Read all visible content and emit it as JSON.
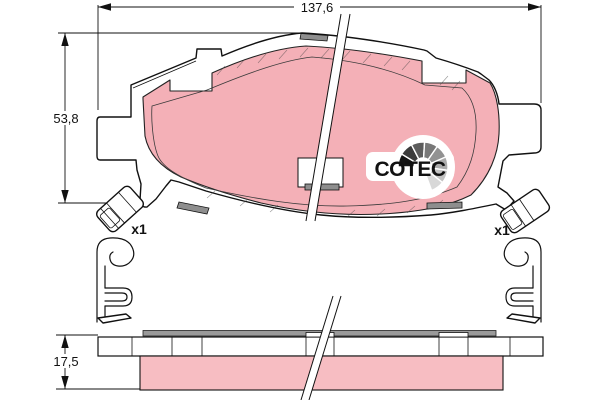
{
  "drawing": {
    "type_note": "brake-pad technical drawing, plan view with section and accessory clips",
    "brand_logo": {
      "text": "COTEC"
    },
    "dimensions": {
      "width_label": "137,6",
      "height_label": "53,8",
      "thickness_label": "17,5"
    },
    "accessories": {
      "left_clip_qty_label": "x1",
      "right_clip_qty_label": "x1"
    },
    "colors": {
      "friction_pink": "#f4b0b7",
      "section_pink": "#f7bdc2",
      "tab_gray": "#8e8e8e",
      "shim_gray": "#9a9a9a",
      "line_black": "#111111",
      "fan_colors": [
        "#141414",
        "#3c3c3c",
        "#5c5c5c",
        "#787878",
        "#929292",
        "#ababab",
        "#c2c2c2",
        "#d8d8d8"
      ]
    }
  }
}
